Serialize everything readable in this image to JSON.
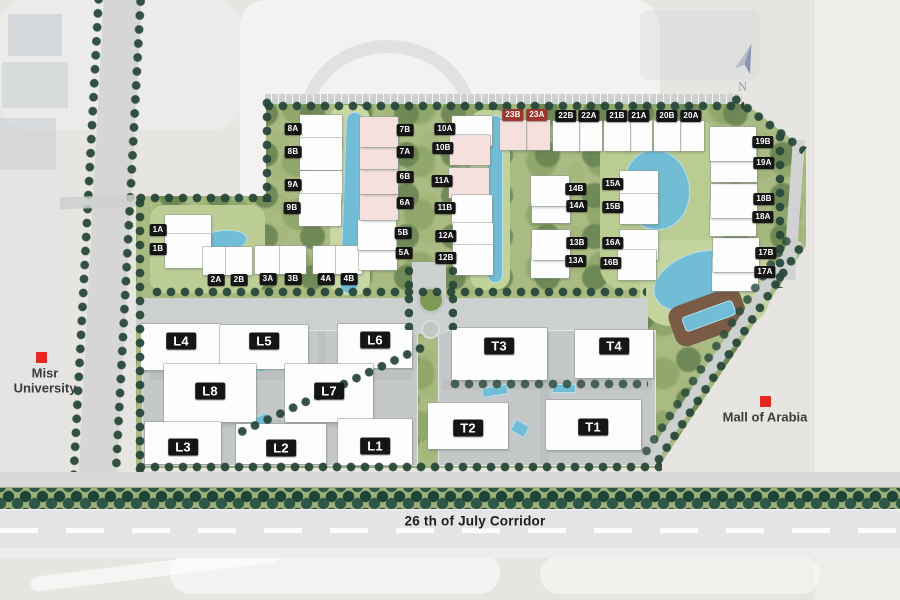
{
  "map": {
    "compass": {
      "label": "N"
    },
    "corridor": {
      "label": "26 th of July Corridor",
      "x": 475,
      "y": 521
    },
    "landmarks": [
      {
        "id": "misr-university",
        "lines": [
          "Misr",
          "University"
        ],
        "x": 45,
        "y": 381,
        "marker_x": 41,
        "marker_y": 357
      },
      {
        "id": "mall-of-arabia",
        "lines": [
          "Mall of Arabia"
        ],
        "x": 765,
        "y": 417,
        "marker_x": 765,
        "marker_y": 401
      }
    ],
    "residential_plots": [
      {
        "id": "1A",
        "x": 158,
        "y": 230,
        "side": "right",
        "w": 46,
        "h": 34
      },
      {
        "id": "1B",
        "x": 158,
        "y": 249,
        "side": "right",
        "w": 46,
        "h": 34
      },
      {
        "id": "2A",
        "x": 216,
        "y": 280,
        "side": "above",
        "w": 26,
        "h": 28
      },
      {
        "id": "2B",
        "x": 239,
        "y": 280,
        "side": "above",
        "w": 26,
        "h": 28
      },
      {
        "id": "3A",
        "x": 268,
        "y": 279,
        "side": "above",
        "w": 26,
        "h": 28
      },
      {
        "id": "3B",
        "x": 293,
        "y": 279,
        "side": "above",
        "w": 26,
        "h": 28
      },
      {
        "id": "4A",
        "x": 326,
        "y": 279,
        "side": "above",
        "w": 26,
        "h": 28
      },
      {
        "id": "4B",
        "x": 349,
        "y": 279,
        "side": "above",
        "w": 26,
        "h": 28
      },
      {
        "id": "5A",
        "x": 404,
        "y": 253,
        "side": "left",
        "w": 38,
        "h": 30
      },
      {
        "id": "5B",
        "x": 403,
        "y": 233,
        "side": "left",
        "w": 38,
        "h": 30
      },
      {
        "id": "6A",
        "x": 405,
        "y": 203,
        "side": "left",
        "w": 38,
        "h": 30,
        "tint": "pink"
      },
      {
        "id": "6B",
        "x": 405,
        "y": 177,
        "side": "left",
        "w": 38,
        "h": 30,
        "tint": "pink"
      },
      {
        "id": "7A",
        "x": 405,
        "y": 152,
        "side": "left",
        "w": 38,
        "h": 30,
        "tint": "pink"
      },
      {
        "id": "7B",
        "x": 405,
        "y": 130,
        "side": "left",
        "w": 38,
        "h": 30,
        "tint": "pink"
      },
      {
        "id": "8A",
        "x": 293,
        "y": 129,
        "side": "right",
        "w": 42,
        "h": 32
      },
      {
        "id": "8B",
        "x": 293,
        "y": 152,
        "side": "right",
        "w": 42,
        "h": 32
      },
      {
        "id": "9A",
        "x": 293,
        "y": 185,
        "side": "right",
        "w": 42,
        "h": 32
      },
      {
        "id": "9B",
        "x": 292,
        "y": 208,
        "side": "right",
        "w": 42,
        "h": 32
      },
      {
        "id": "10A",
        "x": 445,
        "y": 129,
        "side": "right",
        "w": 40,
        "h": 30
      },
      {
        "id": "10B",
        "x": 443,
        "y": 148,
        "side": "right",
        "w": 40,
        "h": 30,
        "tint": "pink"
      },
      {
        "id": "11A",
        "x": 442,
        "y": 181,
        "side": "right",
        "w": 40,
        "h": 30,
        "tint": "pink"
      },
      {
        "id": "11B",
        "x": 445,
        "y": 208,
        "side": "right",
        "w": 40,
        "h": 30
      },
      {
        "id": "12A",
        "x": 446,
        "y": 236,
        "side": "right",
        "w": 40,
        "h": 30
      },
      {
        "id": "12B",
        "x": 446,
        "y": 258,
        "side": "right",
        "w": 40,
        "h": 30
      },
      {
        "id": "13A",
        "x": 576,
        "y": 261,
        "side": "left",
        "w": 38,
        "h": 30
      },
      {
        "id": "13B",
        "x": 577,
        "y": 243,
        "side": "left",
        "w": 38,
        "h": 30
      },
      {
        "id": "14A",
        "x": 577,
        "y": 206,
        "side": "left",
        "w": 38,
        "h": 30
      },
      {
        "id": "14B",
        "x": 576,
        "y": 189,
        "side": "left",
        "w": 38,
        "h": 30
      },
      {
        "id": "15A",
        "x": 613,
        "y": 184,
        "side": "right",
        "w": 38,
        "h": 30
      },
      {
        "id": "15B",
        "x": 613,
        "y": 207,
        "side": "right",
        "w": 38,
        "h": 30
      },
      {
        "id": "16A",
        "x": 613,
        "y": 243,
        "side": "right",
        "w": 38,
        "h": 30
      },
      {
        "id": "16B",
        "x": 611,
        "y": 263,
        "side": "right",
        "w": 38,
        "h": 30
      },
      {
        "id": "17A",
        "x": 765,
        "y": 272,
        "side": "left",
        "w": 46,
        "h": 34
      },
      {
        "id": "17B",
        "x": 766,
        "y": 253,
        "side": "left",
        "w": 46,
        "h": 34
      },
      {
        "id": "18A",
        "x": 763,
        "y": 217,
        "side": "left",
        "w": 46,
        "h": 34
      },
      {
        "id": "18B",
        "x": 764,
        "y": 199,
        "side": "left",
        "w": 46,
        "h": 34
      },
      {
        "id": "19A",
        "x": 764,
        "y": 163,
        "side": "left",
        "w": 46,
        "h": 34
      },
      {
        "id": "19B",
        "x": 763,
        "y": 142,
        "side": "left",
        "w": 46,
        "h": 34
      },
      {
        "id": "20A",
        "x": 691,
        "y": 116,
        "side": "below",
        "w": 26,
        "h": 30
      },
      {
        "id": "20B",
        "x": 667,
        "y": 116,
        "side": "below",
        "w": 26,
        "h": 30
      },
      {
        "id": "21A",
        "x": 639,
        "y": 116,
        "side": "below",
        "w": 26,
        "h": 30
      },
      {
        "id": "21B",
        "x": 617,
        "y": 116,
        "side": "below",
        "w": 26,
        "h": 30
      },
      {
        "id": "22A",
        "x": 589,
        "y": 116,
        "side": "below",
        "w": 26,
        "h": 30
      },
      {
        "id": "22B",
        "x": 566,
        "y": 116,
        "side": "below",
        "w": 26,
        "h": 30
      },
      {
        "id": "23A",
        "x": 537,
        "y": 115,
        "side": "below",
        "w": 26,
        "h": 30,
        "tint": "pink",
        "chip": "red"
      },
      {
        "id": "23B",
        "x": 513,
        "y": 115,
        "side": "below",
        "w": 26,
        "h": 30,
        "tint": "pink",
        "chip": "red"
      }
    ],
    "office_plots": [
      {
        "id": "L4",
        "x": 181,
        "y": 341,
        "w": 80,
        "h": 46,
        "dy": 6
      },
      {
        "id": "L5",
        "x": 264,
        "y": 341,
        "w": 88,
        "h": 44,
        "dy": 6
      },
      {
        "id": "L6",
        "x": 375,
        "y": 340,
        "w": 74,
        "h": 44,
        "dy": 6
      },
      {
        "id": "L8",
        "x": 210,
        "y": 391,
        "w": 92,
        "h": 58,
        "dy": 2
      },
      {
        "id": "L7",
        "x": 329,
        "y": 391,
        "w": 88,
        "h": 58,
        "dy": 2
      },
      {
        "id": "L3",
        "x": 183,
        "y": 447,
        "w": 76,
        "h": 42,
        "dy": -4
      },
      {
        "id": "L2",
        "x": 281,
        "y": 448,
        "w": 90,
        "h": 40,
        "dy": -4
      },
      {
        "id": "L1",
        "x": 375,
        "y": 446,
        "w": 74,
        "h": 46,
        "dy": -4
      },
      {
        "id": "T3",
        "x": 499,
        "y": 346,
        "w": 95,
        "h": 52,
        "dy": 8
      },
      {
        "id": "T4",
        "x": 614,
        "y": 346,
        "w": 78,
        "h": 48,
        "dy": 8
      },
      {
        "id": "T2",
        "x": 468,
        "y": 428,
        "w": 80,
        "h": 46,
        "dy": -2
      },
      {
        "id": "T1",
        "x": 593,
        "y": 427,
        "w": 95,
        "h": 50,
        "dy": -2
      }
    ],
    "colors": {
      "marker_red": "#e8251f",
      "chip_black": "#151515",
      "chip_highlight_red": "#9c3430",
      "water_teal": "#72bdd6",
      "landscape_green": "#a9ba82",
      "road_grey": "#ccd0ce",
      "building_white": "#fefefe",
      "building_pink": "#f6e0dd",
      "tree_dark_green": "#28483a"
    }
  }
}
